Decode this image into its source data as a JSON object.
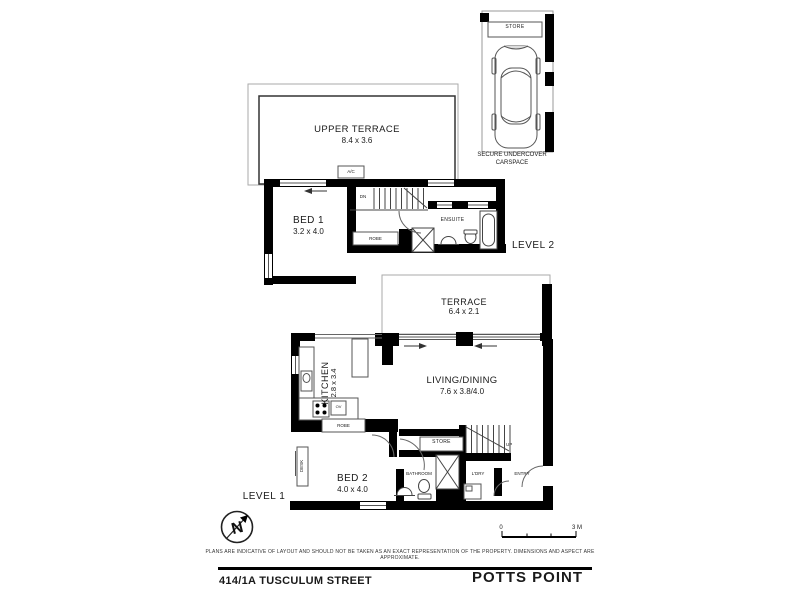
{
  "footer": {
    "address": "414/1A TUSCULUM STREET",
    "suburb": "POTTS POINT",
    "disclaimer": "PLANS ARE INDICATIVE OF LAYOUT AND SHOULD NOT BE TAKEN AS AN EXACT REPRESENTATION OF THE PROPERTY. DIMENSIONS AND ASPECT ARE APPROXIMATE."
  },
  "carspace": {
    "store_label": "STORE",
    "caption_line1": "SECURE UNDERCOVER",
    "caption_line2": "CARSPACE"
  },
  "level2": {
    "label": "LEVEL 2",
    "upper_terrace": {
      "name": "UPPER TERRACE",
      "dims": "8.4 x 3.6"
    },
    "bed1": {
      "name": "BED 1",
      "dims": "3.2 x 4.0"
    },
    "ensuite_label": "ENSUITE",
    "robe_label": "ROBE",
    "ac_label": "A/C",
    "stairs_label": "DN"
  },
  "level1": {
    "label": "LEVEL 1",
    "terrace": {
      "name": "TERRACE",
      "dims": "6.4 x 2.1"
    },
    "living": {
      "name": "LIVING/DINING",
      "dims": "7.6 x 3.8/4.0"
    },
    "kitchen": {
      "name": "KITCHEN",
      "dims": "2.8 x 3.4"
    },
    "bed2": {
      "name": "BED 2",
      "dims": "4.0 x 4.0"
    },
    "bathroom_label": "BATHROOM",
    "store_label": "STORE",
    "laundry_label": "L'DRY",
    "entry_label": "ENTRY",
    "robe_label": "ROBE",
    "desk_label": "DESK",
    "oven_label": "OV",
    "stairs_label": "UP"
  },
  "scale_bar": {
    "start": "0",
    "end": "3 M"
  },
  "compass": {
    "letter": "N"
  }
}
